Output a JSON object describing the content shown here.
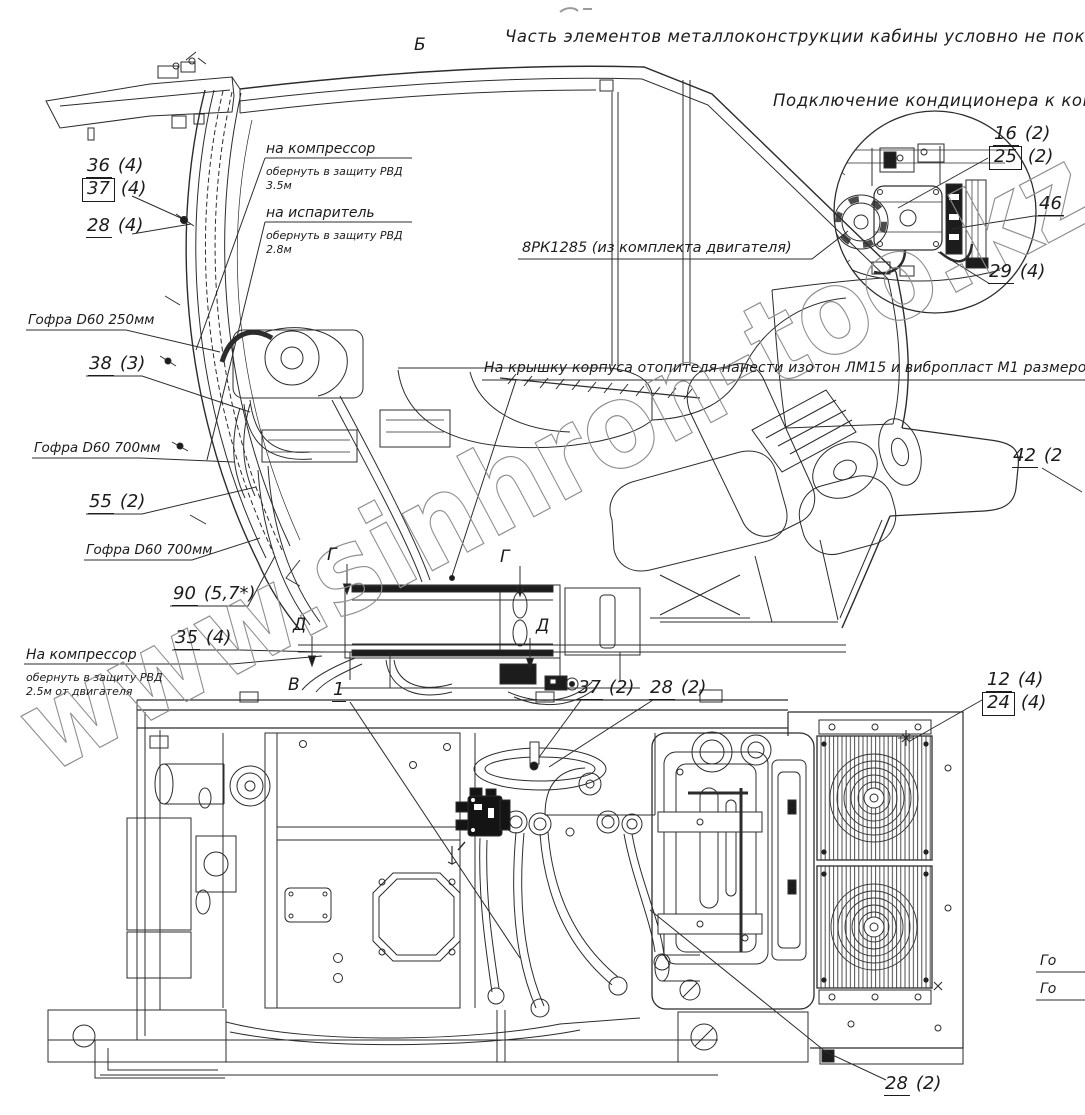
{
  "doc": {
    "top_note": "Часть элементов металлоконструкции кабины условно не показана",
    "detail_title": "Подключение кондиционера к компрессору",
    "belt_note": "8РК1285 (из комплекта двигателя)",
    "heater_note": "На крышку корпуса отопителя нанести изотон ЛМ15 и вибропласт М1 размером 350Х350",
    "watermark": "www.sinhron-too.kz"
  },
  "sections": {
    "b": "Б",
    "v": "В",
    "g": "Г",
    "d": "Д"
  },
  "instructions": {
    "compressor_top": {
      "title": "на компрессор",
      "line1": "обернуть в защиту РВД",
      "line2": "3.5м"
    },
    "evaporator": {
      "title": "на испаритель",
      "line1": "обернуть в защиту РВД",
      "line2": "2.8м"
    },
    "compressor_engine": {
      "title": "На компрессор",
      "line1": "обернуть в защиту РВД",
      "line2": "2.5м от двигателя"
    }
  },
  "hoses": {
    "gofra250": "Гофра D60 250мм",
    "gofra700a": "Гофра D60 700мм",
    "gofra700b": "Гофра D60 700мм",
    "cut1": "Го",
    "cut2": "Го"
  },
  "callouts": {
    "c36": {
      "num": "36",
      "qty": "(4)"
    },
    "c37a": {
      "num": "37",
      "qty": "(4)"
    },
    "c28a": {
      "num": "28",
      "qty": "(4)"
    },
    "c16": {
      "num": "16",
      "qty": "(2)"
    },
    "c25": {
      "num": "25",
      "qty": "(2)"
    },
    "c46": {
      "num": "46",
      "qty": ""
    },
    "c29": {
      "num": "29",
      "qty": "(4)"
    },
    "c38": {
      "num": "38",
      "qty": "(3)"
    },
    "c55": {
      "num": "55",
      "qty": "(2)"
    },
    "c90": {
      "num": "90",
      "qty": "(5,7*)"
    },
    "c35": {
      "num": "35",
      "qty": "(4)"
    },
    "c42": {
      "num": "42",
      "qty": "(2"
    },
    "c1": {
      "num": "1",
      "qty": ""
    },
    "c37b": {
      "num": "37",
      "qty": "(2)"
    },
    "c28b": {
      "num": "28",
      "qty": "(2)"
    },
    "c12": {
      "num": "12",
      "qty": "(4)"
    },
    "c24": {
      "num": "24",
      "qty": "(4)"
    },
    "c28c": {
      "num": "28",
      "qty": "(2)"
    }
  }
}
